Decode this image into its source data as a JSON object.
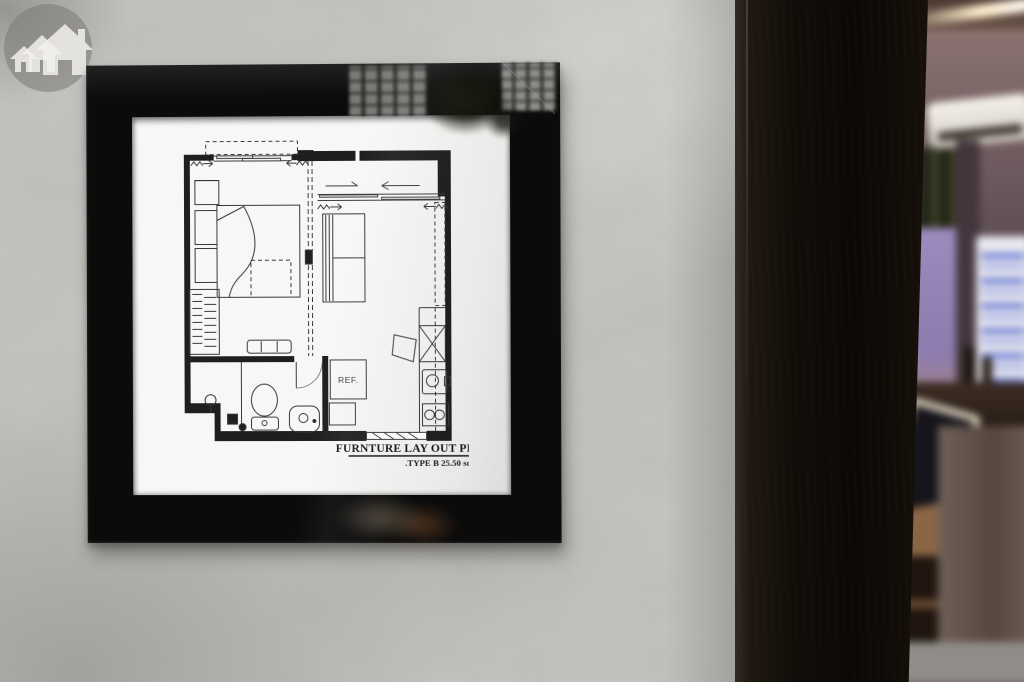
{
  "framed_plan": {
    "title": "FURNTURE LAY OUT PLAN",
    "type_label": ".TYPE B 25.50 sqm",
    "ref_label": "REF."
  },
  "watermark": {
    "icon": "houses-icon"
  },
  "colors": {
    "wall": "#c7c6c2",
    "frame": "#0b0b0b",
    "mat": "#f5f5f3",
    "plan_ink": "#2e2e2e",
    "pillar": "#120d08",
    "window_glow": "#9d8bc0",
    "warm_light": "#d08b4f",
    "poster_blue": "#5a6ed0"
  }
}
